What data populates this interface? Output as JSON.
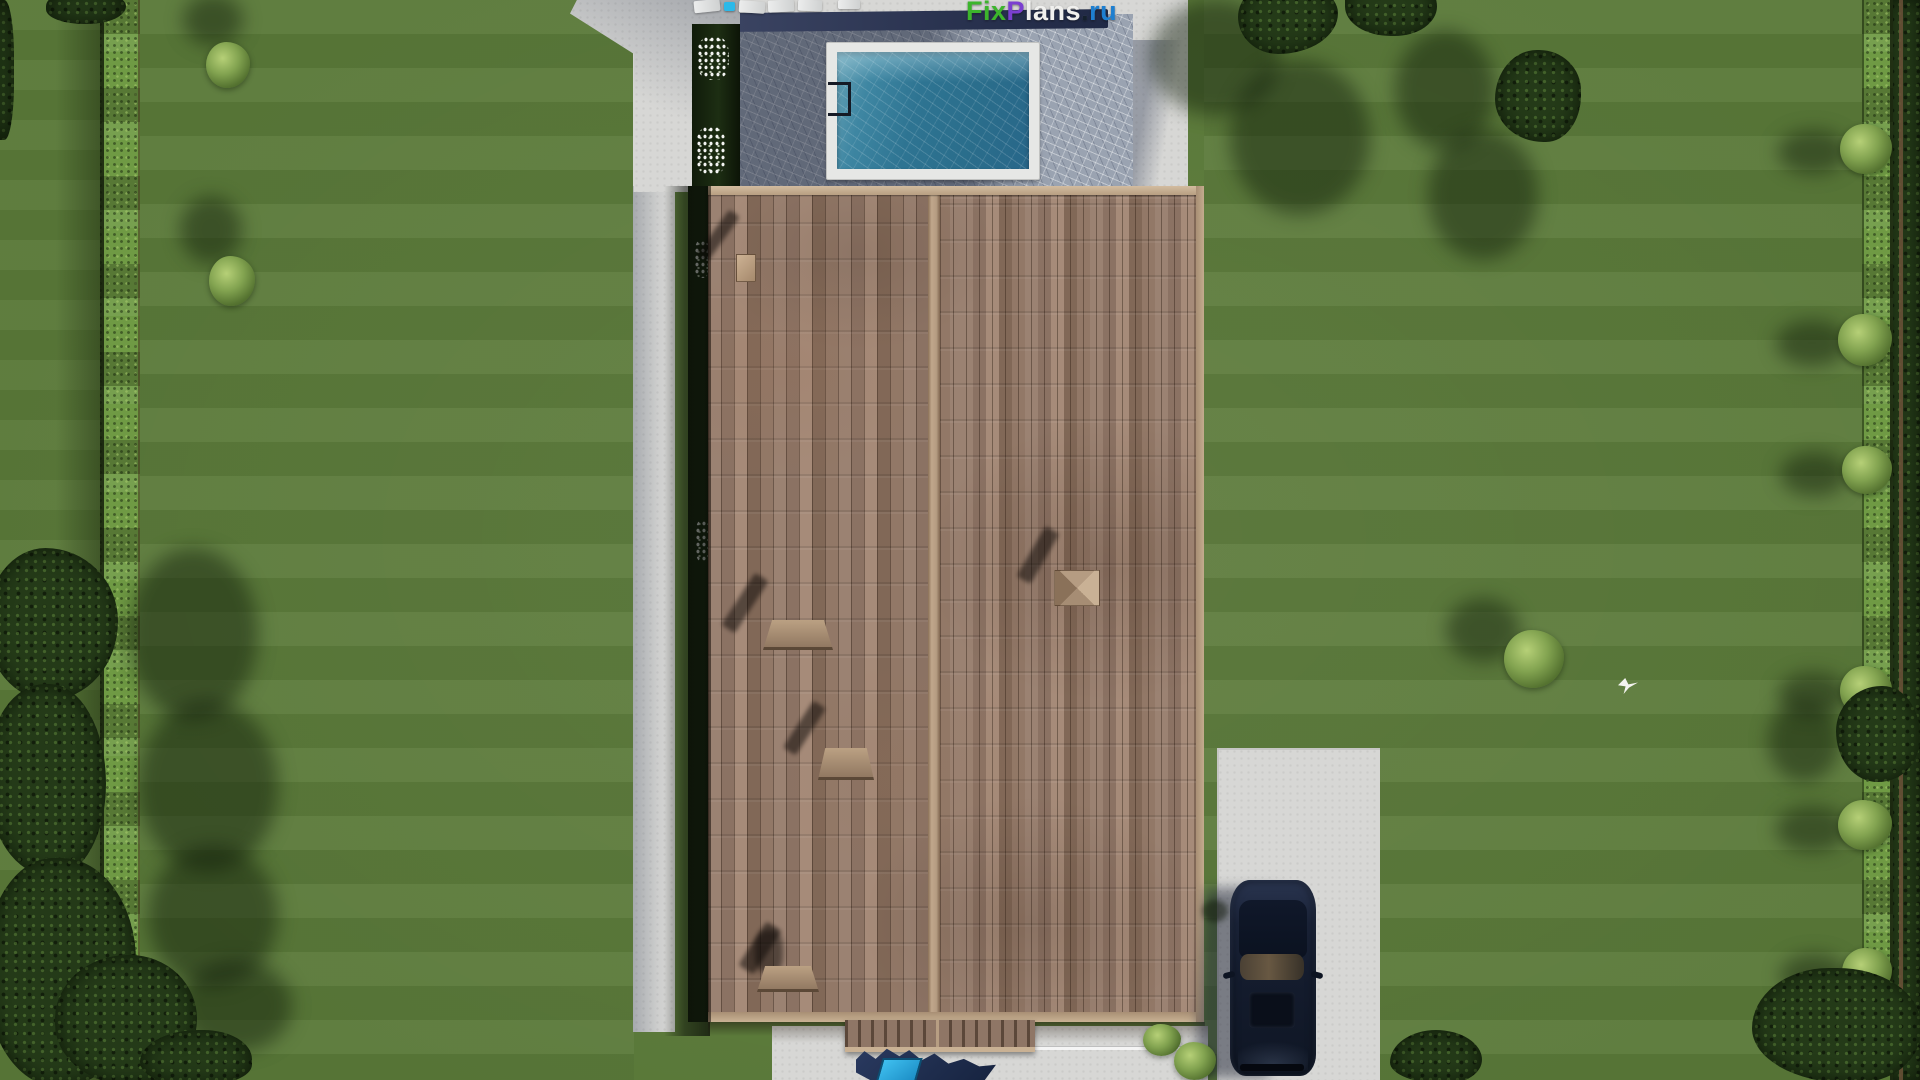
{
  "watermark": {
    "full_text": "FixPlans.ru",
    "segments": [
      {
        "text": "Fix",
        "color": "#3cb52c"
      },
      {
        "text": "P",
        "color": "#7b3fd0"
      },
      {
        "text": "lans",
        "color": "#f0f0ee"
      },
      {
        "text": ".",
        "color": "#15212e"
      },
      {
        "text": "ru",
        "color": "#1e7fd0"
      }
    ]
  },
  "scene": {
    "type": "aerial-3d-architectural-render",
    "subject": "top-down view of a gable-roof house with pool terrace, garden lawn, hedges, driveway and parked SUV",
    "objects": [
      "lawn",
      "boundary-hedge",
      "garden-trees",
      "garden-bushes",
      "concrete-path",
      "pool-apron",
      "pool-terrace",
      "swimming-pool",
      "pool-ladder",
      "sun-loungers",
      "flower-bed",
      "roof-left-slope",
      "roof-right-slope",
      "roof-ridge",
      "roof-vent",
      "roof-skylight",
      "roof-chimney",
      "porch-roof",
      "entrance-walkway",
      "partial-logo-watermark",
      "driveway",
      "suv-car",
      "flying-bird"
    ]
  },
  "colors": {
    "lawn": "#597838",
    "lawn_shadow": "#35501f",
    "hedge": "#6f9a44",
    "tree_canopy": "#243a18",
    "concrete": "#d7d7d5",
    "terrace_stone": "#9aa3b1",
    "terrace_wall": "#2b3350",
    "pool_rim": "#e6e7e5",
    "pool_water": "#2e7492",
    "roof_tile": "#967d6c",
    "roof_fascia": "#c8b094",
    "car_body": "#141c2e",
    "logo_cyan": "#2cb9e9"
  }
}
